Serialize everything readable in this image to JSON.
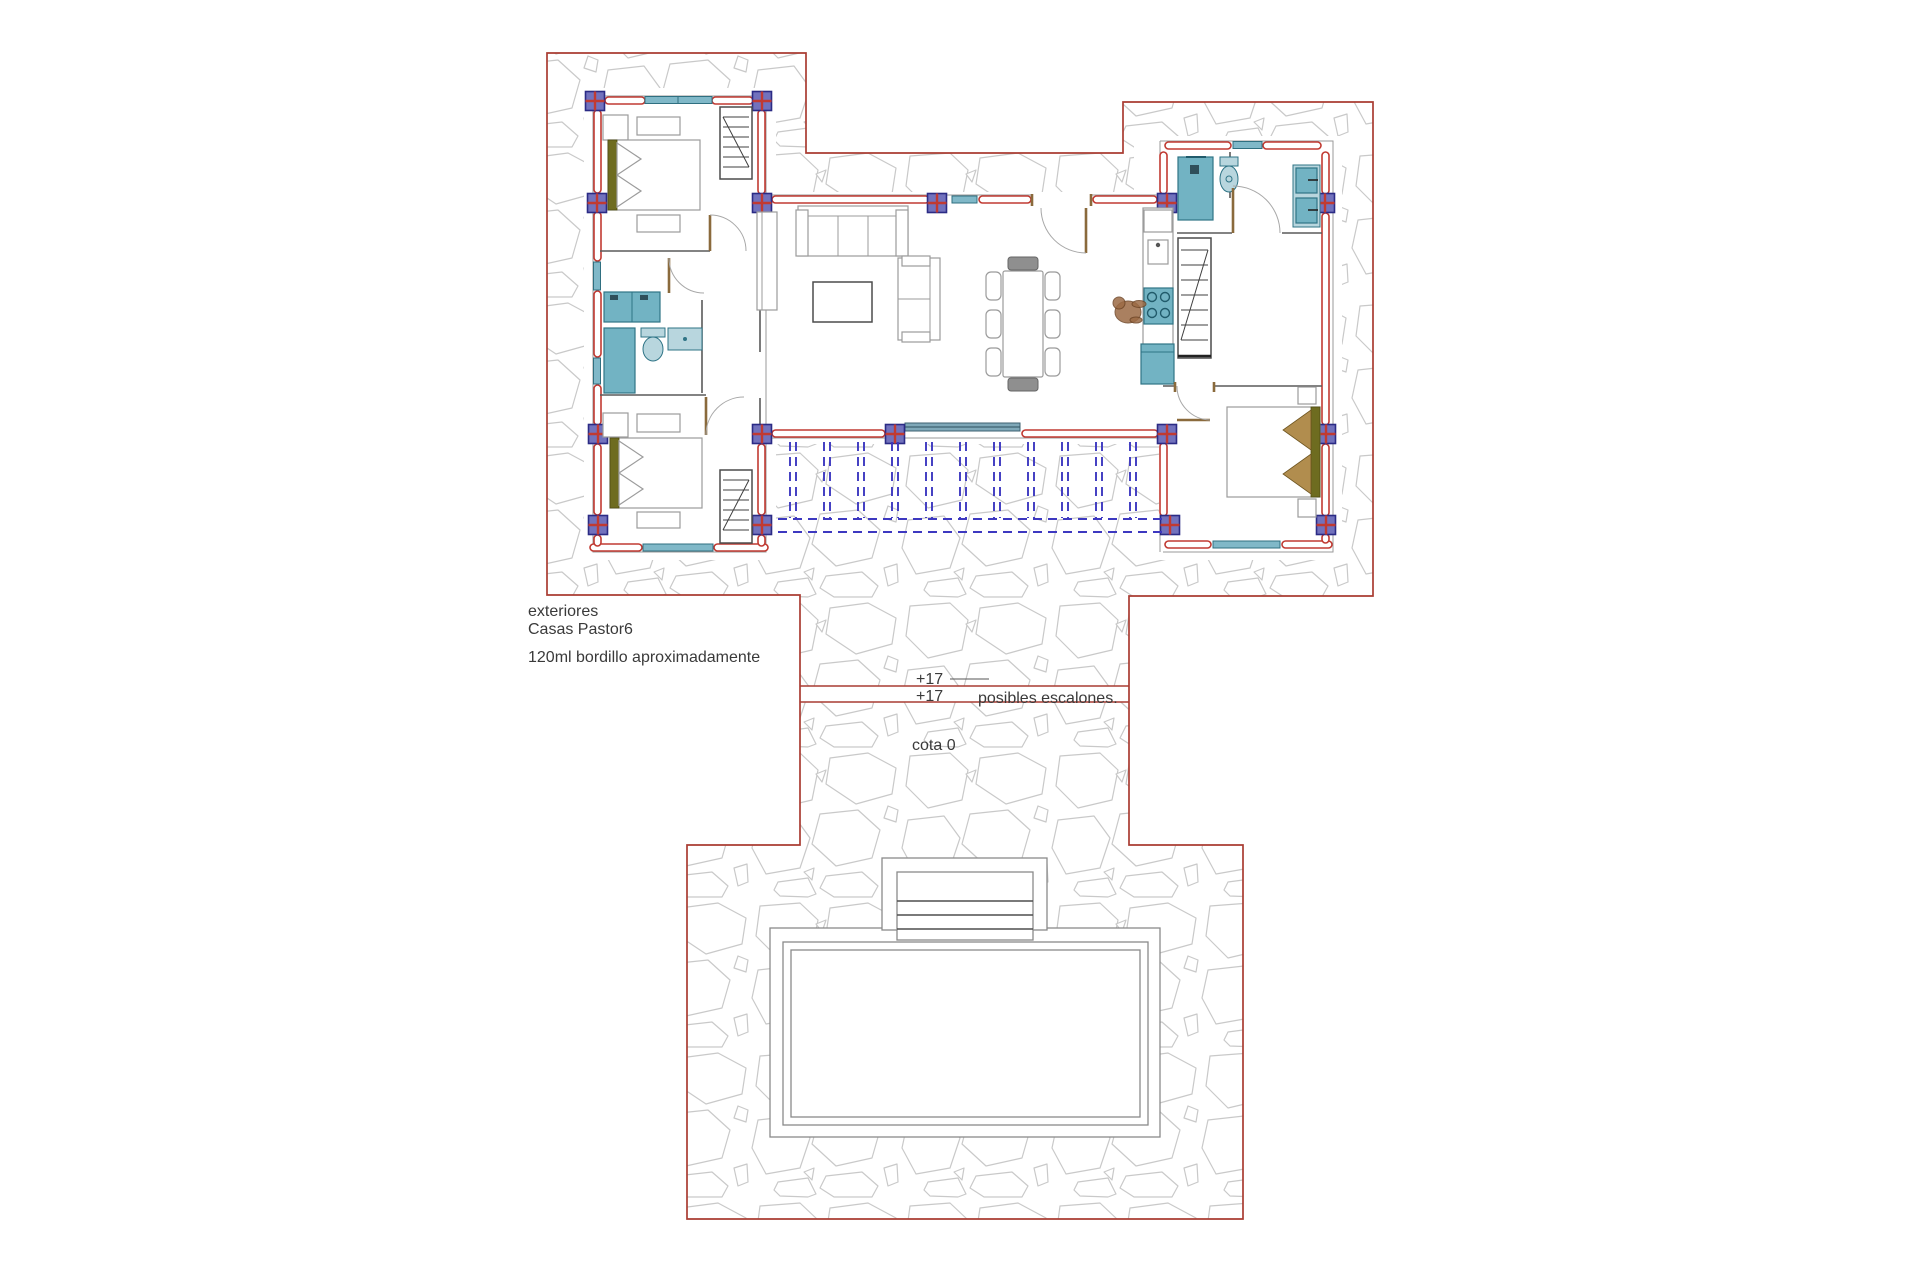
{
  "labels": {
    "exteriores": "exteriores",
    "project": "Casas Pastor6",
    "curb_note": "120ml bordillo aproximadamente",
    "level_upper_a": "+17",
    "level_upper_b": "+17",
    "steps_note": "posibles escalones.",
    "level_zero": "cota 0"
  },
  "colors": {
    "boundary-red": "#a93c32",
    "wall-red": "#c13a32",
    "pilaster-fill": "#7272bd",
    "pilaster-border": "#2b2b85",
    "window-teal": "#80b8c8",
    "window-dark": "#2f6f80",
    "slider-steel": "#7fa8b8",
    "fixture-teal": "#72b3c3",
    "fixture-dark": "#2f7486",
    "fixture-light": "#b8d6de",
    "pergola-blue": "#3d38c0",
    "stone-gray": "#c9c9c9",
    "furniture-gray": "#9b9b9b",
    "olive": "#6e6c20",
    "tan": "#b18d4e",
    "wood-brown": "#8a6a3c",
    "person-brown": "#9c6b45",
    "text-dark": "#3a3a3a"
  }
}
